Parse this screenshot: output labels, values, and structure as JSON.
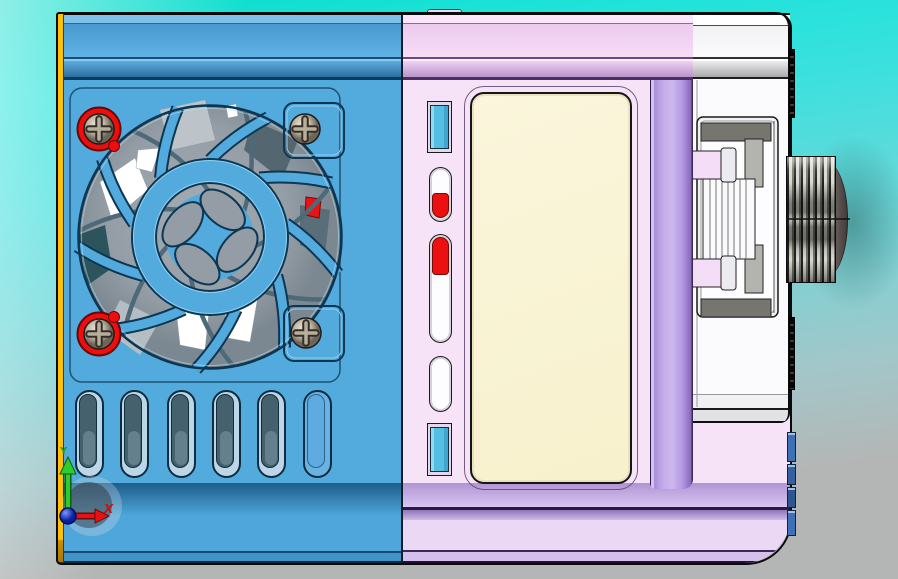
{
  "scene": {
    "description": "3D CAD shaded view of a fan-cooled electronic device with LCD screen, side latch and rotary knob",
    "axis_triad": {
      "x_label": "X",
      "y_label": "Y"
    },
    "colors": {
      "background_top": "#06dcc9",
      "background_bottom": "#b4b6b5",
      "housing_blue": "#53aadd",
      "housing_pink": "#f7e3f8",
      "edge_lavender": "#bda4e6",
      "side_panel_white": "#fbfbfd",
      "edge_yellow": "#ffc107",
      "screen_cream": "#faf4d5",
      "accent_red": "#ee1111",
      "slot_cyan": "#55bfe3",
      "fan_gray": "#949da5",
      "knob_gray": "#8a8a84",
      "hinge_blue": "#3e70b5",
      "axis_x_red": "#cc1111",
      "axis_y_green": "#18a018",
      "axis_origin_blue": "#1133cc"
    }
  }
}
